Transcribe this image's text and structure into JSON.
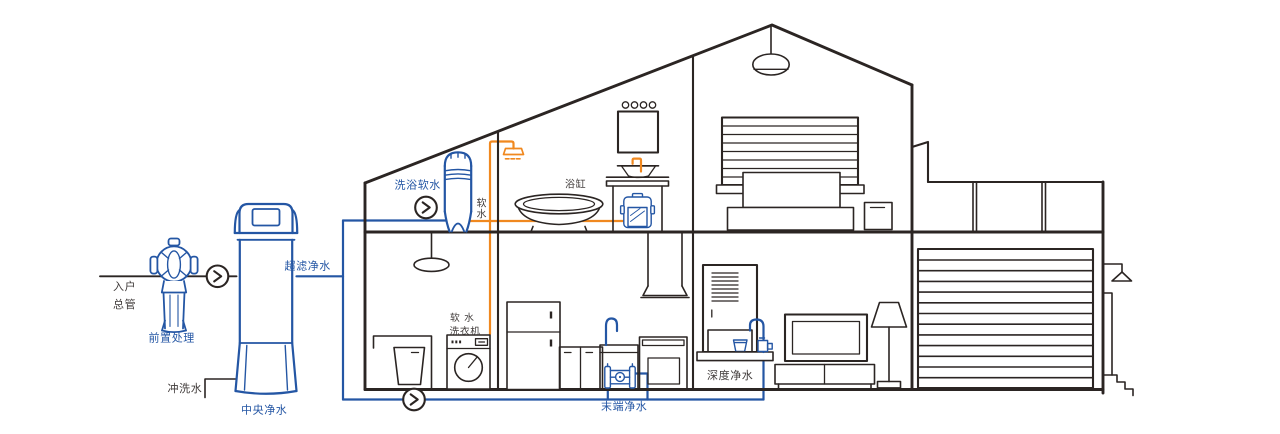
{
  "labels": {
    "inlet_line1": "入户",
    "inlet_line2": "总管",
    "pre_treatment": "前置处理",
    "flush_water": "冲洗水",
    "central_purifier": "中央净水",
    "ultrafiltration": "超滤净水",
    "bath_softener": "洗浴软水",
    "soft_water_char1": "软",
    "soft_water_char2": "水",
    "bathtub": "浴缸",
    "soft_washer_line1": "软 水",
    "soft_washer_line2": "洗衣机",
    "terminal_purifier": "末端净水",
    "deep_purifier": "深度净水"
  },
  "colors": {
    "pipe_blue": "#2456a4",
    "pipe_orange": "#f0881f",
    "line_ink": "#2b2523",
    "text_dark": "#3f3a39"
  },
  "icons": {
    "flow_arrow": "chevron-right-in-circle",
    "shower": "shower-head",
    "outdoor_tap": "tap-triangle"
  }
}
